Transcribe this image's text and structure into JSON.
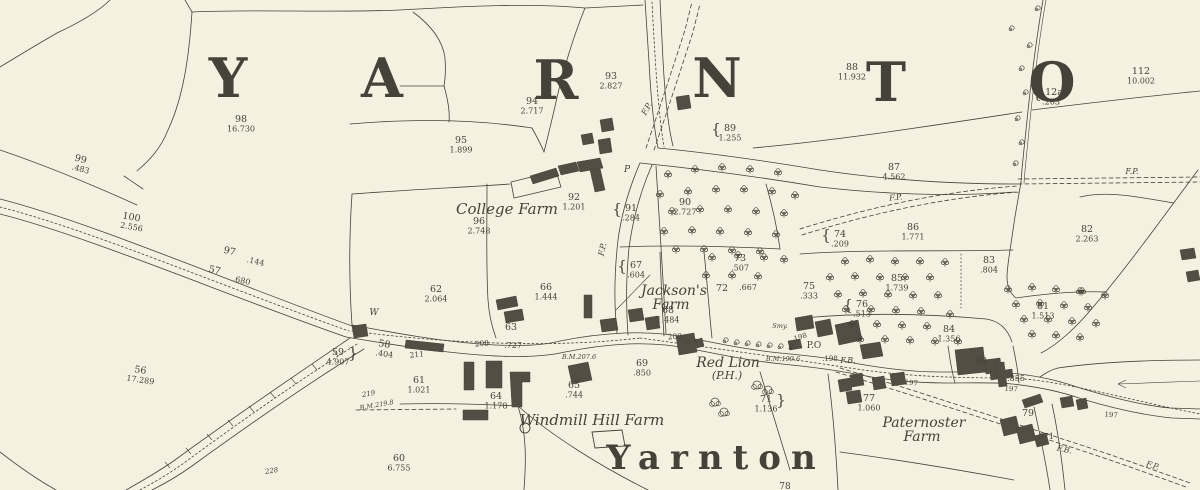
{
  "map": {
    "district_name_letters": [
      {
        "ch": "Y",
        "x": 228,
        "y": 97
      },
      {
        "ch": "A",
        "x": 382,
        "y": 97
      },
      {
        "ch": "R",
        "x": 556,
        "y": 99
      },
      {
        "ch": "N",
        "x": 717,
        "y": 97
      },
      {
        "ch": "T",
        "x": 886,
        "y": 101
      },
      {
        "ch": "O",
        "x": 1052,
        "y": 101
      }
    ],
    "village_label": {
      "text": "Yarnton",
      "x": 716,
      "y": 469
    },
    "place_names": [
      {
        "text": "College Farm",
        "x": 507,
        "y": 214,
        "size": 15
      },
      {
        "text": "Jackson's",
        "x": 674,
        "y": 295,
        "size": 14
      },
      {
        "text": "Farm",
        "x": 671,
        "y": 309,
        "size": 14
      },
      {
        "text": "Red Lion",
        "x": 728,
        "y": 367,
        "size": 14
      },
      {
        "text": "(P.H.)",
        "x": 727,
        "y": 379,
        "size": 11
      },
      {
        "text": "Windmill Hill Farm",
        "x": 592,
        "y": 425,
        "size": 15
      },
      {
        "text": "Paternoster",
        "x": 924,
        "y": 427,
        "size": 14
      },
      {
        "text": "Farm",
        "x": 922,
        "y": 441,
        "size": 14
      }
    ],
    "parcels": [
      {
        "n": "98",
        "a": "16.730",
        "x": 241,
        "y": 122
      },
      {
        "n": "99",
        "a": ".483",
        "x": 80,
        "y": 162,
        "rot": 15
      },
      {
        "n": "100",
        "a": "2.556",
        "x": 131,
        "y": 220,
        "rot": 10
      },
      {
        "n": "93",
        "a": "2.827",
        "x": 611,
        "y": 79
      },
      {
        "n": "94",
        "a": "2.717",
        "x": 532,
        "y": 104
      },
      {
        "n": "95",
        "a": "1.899",
        "x": 461,
        "y": 143
      },
      {
        "n": "89",
        "a": "1.255",
        "x": 730,
        "y": 131,
        "bracket": true
      },
      {
        "n": "88",
        "a": "11.932",
        "x": 852,
        "y": 70
      },
      {
        "n": "112",
        "a": "10.002",
        "x": 1141,
        "y": 74
      },
      {
        "n": "112a",
        "a": ".263",
        "x": 1051,
        "y": 95,
        "bracket": true
      },
      {
        "n": "87",
        "a": "4.562",
        "x": 894,
        "y": 170
      },
      {
        "n": "86",
        "a": "1.771",
        "x": 913,
        "y": 230
      },
      {
        "n": "82",
        "a": "2.263",
        "x": 1087,
        "y": 232
      },
      {
        "n": "83",
        "a": ".804",
        "x": 989,
        "y": 263
      },
      {
        "n": "74",
        "a": ".209",
        "x": 840,
        "y": 237,
        "bracket": true
      },
      {
        "n": "85",
        "a": "1.739",
        "x": 897,
        "y": 281
      },
      {
        "n": "75",
        "a": ".333",
        "x": 809,
        "y": 289
      },
      {
        "n": "76",
        "a": ".513",
        "x": 862,
        "y": 307,
        "bracket": true
      },
      {
        "n": "81",
        "a": "1.513",
        "x": 1043,
        "y": 309
      },
      {
        "n": "84",
        "a": "1.356",
        "x": 949,
        "y": 332
      },
      {
        "n": "73",
        "a": ".507",
        "x": 740,
        "y": 261
      },
      {
        "n": "72",
        "a": ".667",
        "x": 722,
        "y": 291,
        "ax": 748,
        "ay": 290
      },
      {
        "n": "67",
        "a": ".604",
        "x": 636,
        "y": 268,
        "bracket": true
      },
      {
        "n": "68",
        "a": "1.484",
        "x": 668,
        "y": 313
      },
      {
        "n": "90",
        "a": "2.727",
        "x": 685,
        "y": 205
      },
      {
        "n": "91",
        "a": ".284",
        "x": 631,
        "y": 211,
        "bracket": true
      },
      {
        "n": "92",
        "a": "1.201",
        "x": 574,
        "y": 200
      },
      {
        "n": "96",
        "a": "2.748",
        "x": 479,
        "y": 224
      },
      {
        "n": "62",
        "a": "2.064",
        "x": 436,
        "y": 292
      },
      {
        "n": "66",
        "a": "1.444",
        "x": 546,
        "y": 290
      },
      {
        "n": "63",
        "a": ".727",
        "x": 511,
        "y": 330,
        "ax": 513,
        "ay": 348
      },
      {
        "n": "56",
        "a": "17.289",
        "x": 140,
        "y": 373,
        "rot": 8
      },
      {
        "n": "59",
        "a": "4.907",
        "x": 338,
        "y": 355,
        "bracketR": true
      },
      {
        "n": "58",
        "a": ".404",
        "x": 384,
        "y": 347,
        "rot": 8
      },
      {
        "n": "61",
        "a": "1.021",
        "x": 419,
        "y": 383
      },
      {
        "n": "64",
        "a": "1.178",
        "x": 496,
        "y": 399
      },
      {
        "n": "65",
        "a": ".744",
        "x": 574,
        "y": 388
      },
      {
        "n": "69",
        "a": ".850",
        "x": 642,
        "y": 366
      },
      {
        "n": "71",
        "a": "1.136",
        "x": 766,
        "y": 402,
        "bracketR": true
      },
      {
        "n": "77",
        "a": "1.060",
        "x": 869,
        "y": 401
      },
      {
        "n": "80",
        "a": ".855",
        "x": 981,
        "y": 364,
        "ax": 1016,
        "ay": 381
      },
      {
        "n": "79",
        "a": ".871",
        "x": 1028,
        "y": 416,
        "ax": 1045,
        "ay": 439
      },
      {
        "n": "60",
        "a": "6.755",
        "x": 399,
        "y": 461
      },
      {
        "n": "97",
        "a": ".144",
        "x": 229,
        "y": 254,
        "ax": 255,
        "ay": 264,
        "rot": 13
      },
      {
        "n": "57",
        "a": ".680",
        "x": 214,
        "y": 273,
        "ax": 241,
        "ay": 283,
        "rot": 13
      }
    ],
    "small_labels": [
      {
        "text": "F.P.",
        "x": 649,
        "y": 110,
        "rot": -62,
        "italic": true
      },
      {
        "text": "F.P.",
        "x": 605,
        "y": 250,
        "rot": -78,
        "italic": true
      },
      {
        "text": "F.P.",
        "x": 896,
        "y": 200,
        "rot": -6,
        "italic": true
      },
      {
        "text": "F.P.",
        "x": 1132,
        "y": 174,
        "italic": true
      },
      {
        "text": "F.P.",
        "x": 1152,
        "y": 468,
        "rot": 16,
        "italic": true
      },
      {
        "text": "F.B.",
        "x": 848,
        "y": 363,
        "italic": true
      },
      {
        "text": "F.B.",
        "x": 1064,
        "y": 452,
        "rot": 12,
        "italic": true
      },
      {
        "text": "P.O",
        "x": 814,
        "y": 348,
        "size": 9
      },
      {
        "text": "W",
        "x": 374,
        "y": 315,
        "italic": true,
        "size": 9
      },
      {
        "text": "P",
        "x": 627,
        "y": 172,
        "italic": true,
        "size": 9
      },
      {
        "text": "Smy.",
        "x": 780,
        "y": 328,
        "italic": true,
        "size": 6.5
      },
      {
        "text": "B.M.207.6",
        "x": 579,
        "y": 359,
        "italic": true,
        "size": 6.5
      },
      {
        "text": "B.M.199.6",
        "x": 783,
        "y": 361,
        "italic": true,
        "size": 6.5
      },
      {
        "text": "B.M.219.8",
        "x": 377,
        "y": 407,
        "italic": true,
        "size": 6.5,
        "rot": -10
      },
      {
        "text": "219",
        "x": 369,
        "y": 396,
        "italic": true,
        "size": 7,
        "rot": -10
      },
      {
        "text": "228",
        "x": 272,
        "y": 473,
        "italic": true,
        "size": 7,
        "rot": -10
      },
      {
        "text": "208",
        "x": 482,
        "y": 346,
        "size": 7.5,
        "rot": -4
      },
      {
        "text": "211",
        "x": 417,
        "y": 357,
        "size": 7.5,
        "rot": -6
      },
      {
        "text": "200",
        "x": 675,
        "y": 339,
        "size": 7.5,
        "rot": -4
      },
      {
        "text": "198",
        "x": 801,
        "y": 339,
        "size": 7,
        "rot": -18
      },
      {
        "text": ".198",
        "x": 830,
        "y": 361,
        "size": 7
      },
      {
        "text": "197",
        "x": 911,
        "y": 385,
        "size": 7,
        "rot": 6
      },
      {
        "text": "197",
        "x": 1011,
        "y": 391,
        "size": 7,
        "rot": 4
      },
      {
        "text": "197",
        "x": 1111,
        "y": 417,
        "size": 7,
        "rot": 4
      },
      {
        "text": "78",
        "x": 785,
        "y": 489,
        "size": 9
      }
    ],
    "colors": {
      "paper": "#f5f1e0",
      "ink": "#45423a",
      "text_ink": "#2a2820",
      "building_fill": "#524e44",
      "big_letter_ink": "#1f1d17"
    }
  }
}
